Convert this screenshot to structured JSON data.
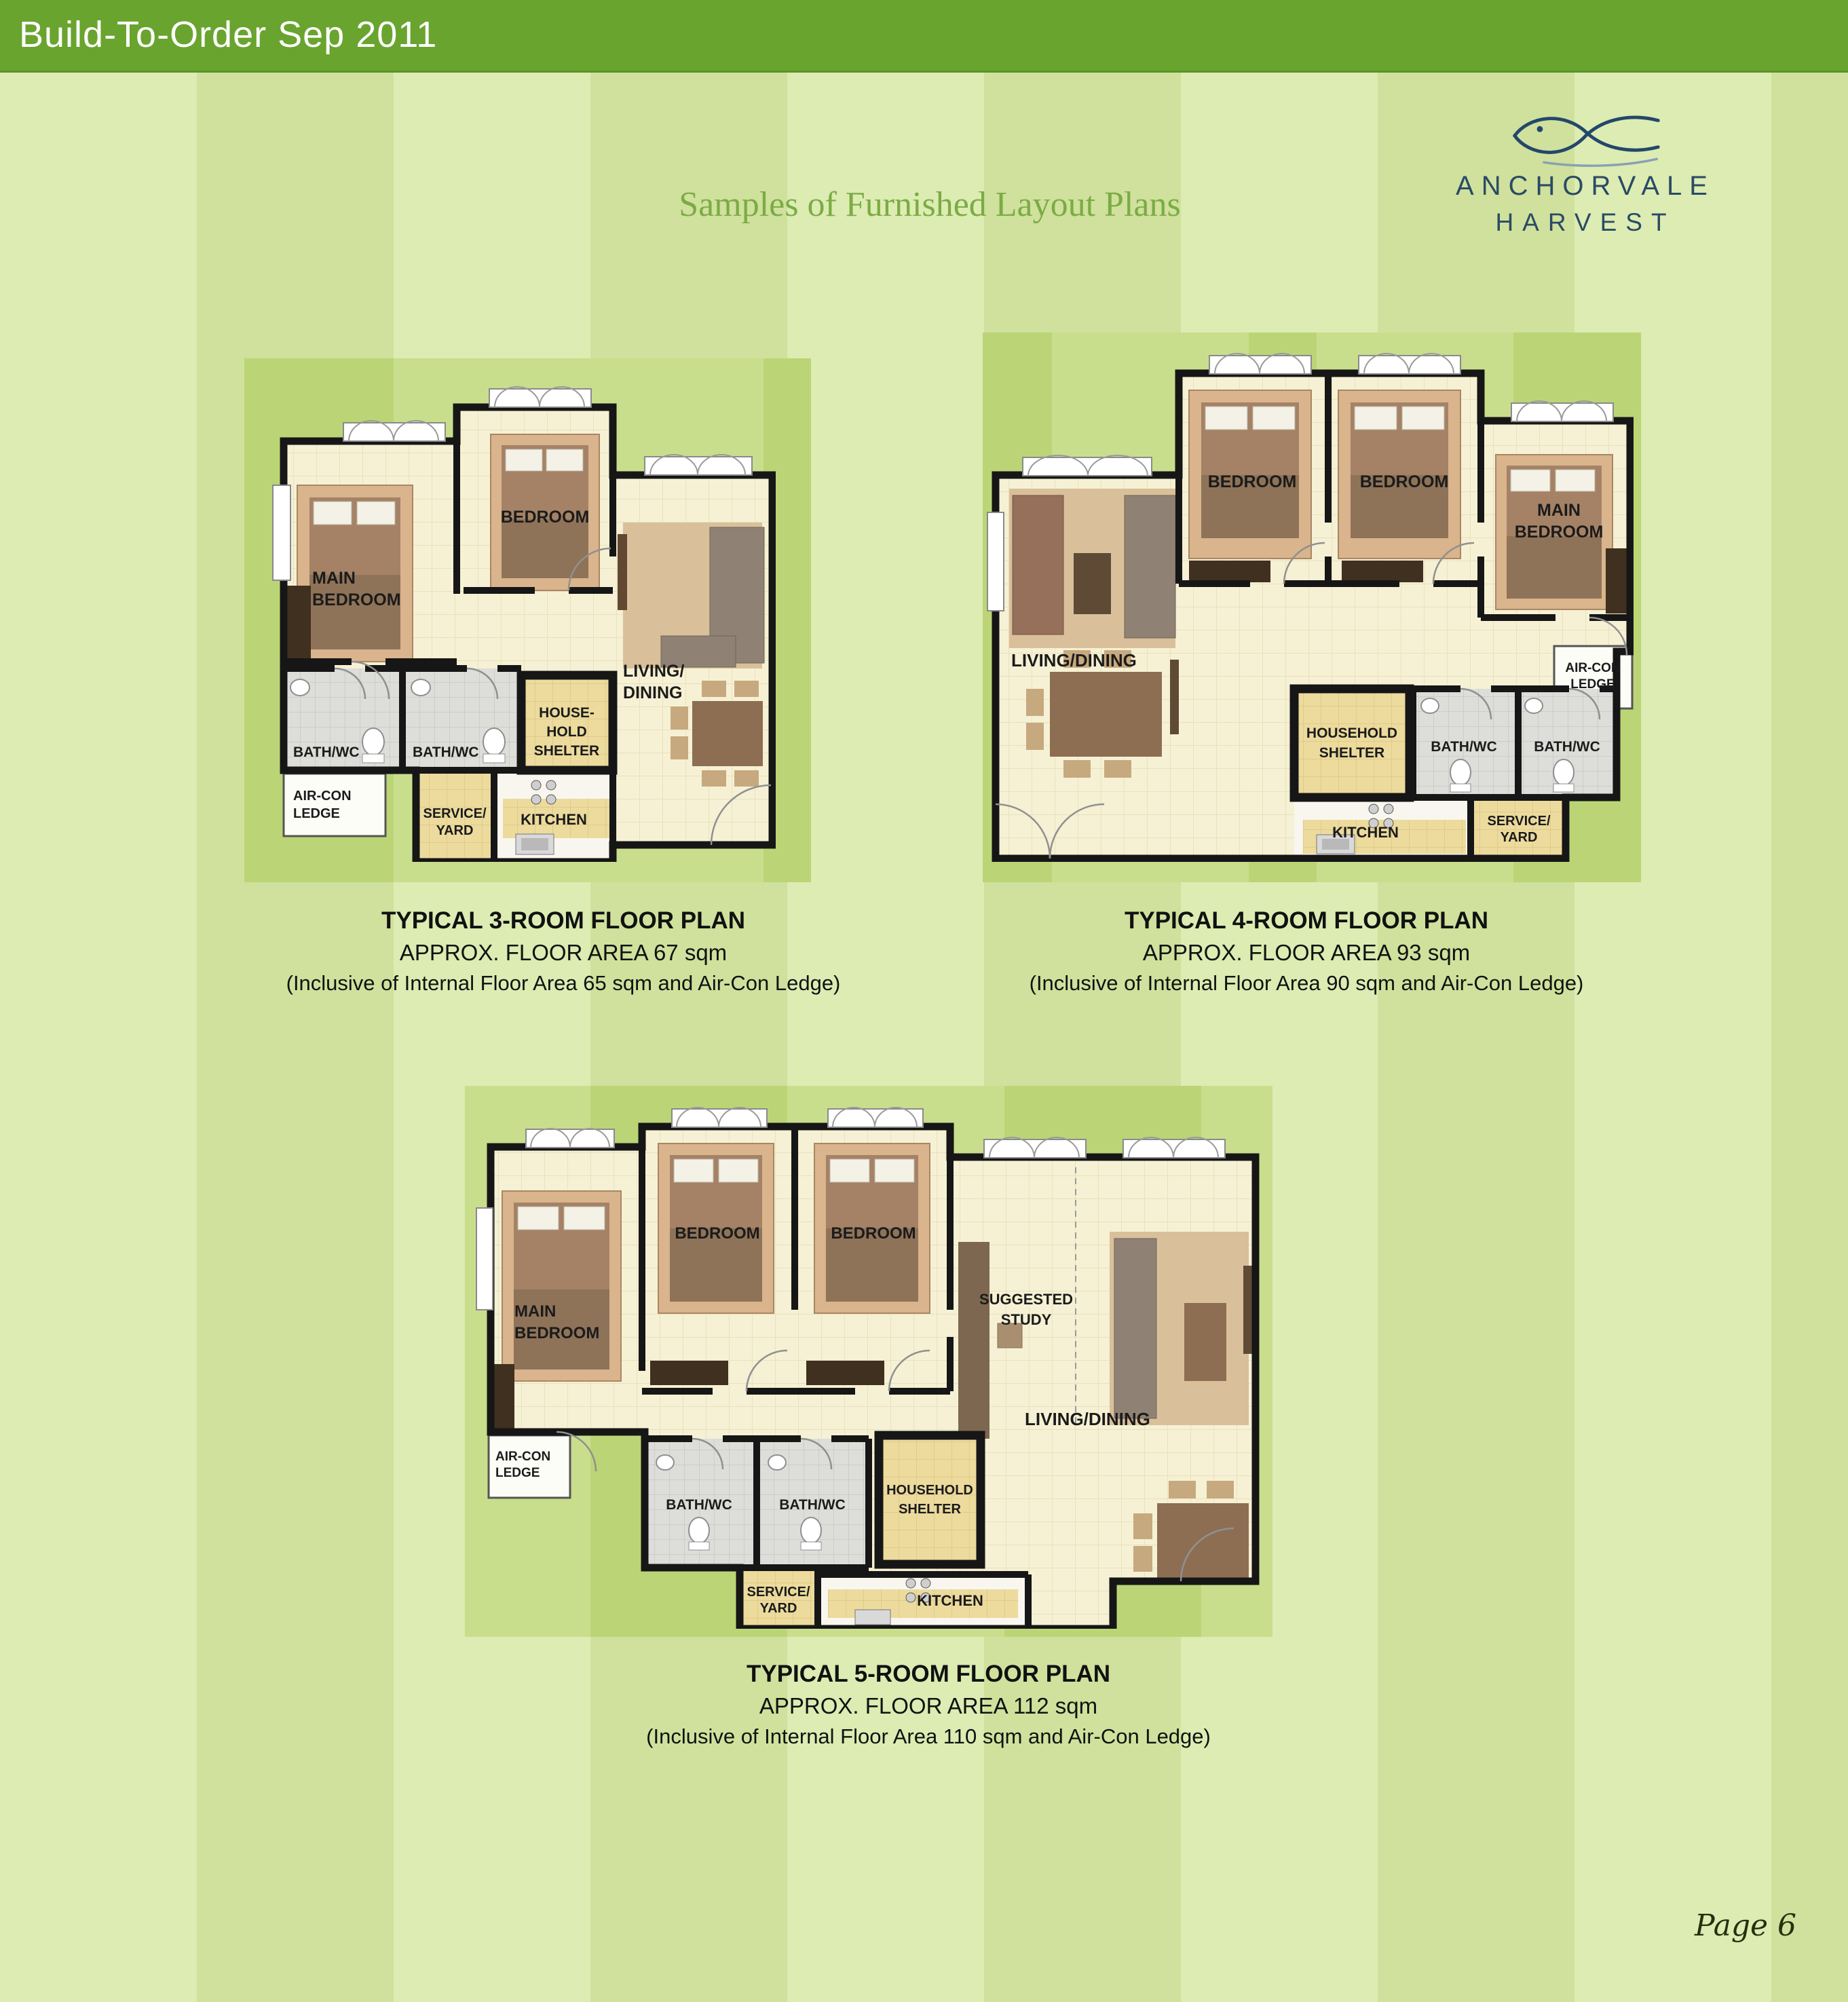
{
  "page": {
    "header": {
      "title": "Build-To-Order Sep 2011",
      "bg_color": "#69a42f",
      "text_color": "#ffffff"
    },
    "title": {
      "text": "Samples of Furnished Layout Plans",
      "color": "#7cab45"
    },
    "logo": {
      "line1": "ANCHORVALE",
      "line2": "HARVEST",
      "icon": "fish-logo-icon",
      "color": "#2b4a66"
    },
    "page_number": "Page 6",
    "background": {
      "stripe_light": "#dcecb2",
      "stripe_dark": "#cfe19c",
      "plan_stripe_light": "#c9de8c",
      "plan_stripe_dark": "#bbd576"
    }
  },
  "plans": [
    {
      "name": "3-room",
      "caption": {
        "line1": "TYPICAL 3-ROOM FLOOR PLAN",
        "line2": "APPROX. FLOOR AREA 67 sqm",
        "line3": "(Inclusive of Internal Floor Area 65 sqm and Air-Con Ledge)"
      },
      "labels": {
        "main_bedroom": [
          "MAIN",
          "BEDROOM"
        ],
        "bedroom": [
          "BEDROOM"
        ],
        "living_dining": [
          "LIVING/",
          "DINING"
        ],
        "bath1": [
          "BATH/WC"
        ],
        "bath2": [
          "BATH/WC"
        ],
        "household_shelter": [
          "HOUSE-",
          "HOLD",
          "SHELTER"
        ],
        "aircon_ledge": [
          "AIR-CON",
          "LEDGE"
        ],
        "service_yard": [
          "SERVICE/",
          "YARD"
        ],
        "kitchen": [
          "KITCHEN"
        ]
      }
    },
    {
      "name": "4-room",
      "caption": {
        "line1": "TYPICAL 4-ROOM FLOOR PLAN",
        "line2": "APPROX. FLOOR AREA 93 sqm",
        "line3": "(Inclusive of Internal Floor Area 90 sqm and Air-Con Ledge)"
      },
      "labels": {
        "bedroom1": [
          "BEDROOM"
        ],
        "bedroom2": [
          "BEDROOM"
        ],
        "main_bedroom": [
          "MAIN",
          "BEDROOM"
        ],
        "living_dining": [
          "LIVING/DINING"
        ],
        "household_shelter": [
          "HOUSEHOLD",
          "SHELTER"
        ],
        "bath1": [
          "BATH/WC"
        ],
        "bath2": [
          "BATH/WC"
        ],
        "aircon_ledge": [
          "AIR-CON",
          "LEDGE"
        ],
        "kitchen": [
          "KITCHEN"
        ],
        "service_yard": [
          "SERVICE/",
          "YARD"
        ]
      }
    },
    {
      "name": "5-room",
      "caption": {
        "line1": "TYPICAL 5-ROOM FLOOR PLAN",
        "line2": "APPROX. FLOOR AREA 112 sqm",
        "line3": "(Inclusive of Internal Floor Area 110 sqm and Air-Con Ledge)"
      },
      "labels": {
        "main_bedroom": [
          "MAIN",
          "BEDROOM"
        ],
        "bedroom1": [
          "BEDROOM"
        ],
        "bedroom2": [
          "BEDROOM"
        ],
        "suggested_study": [
          "SUGGESTED",
          "STUDY"
        ],
        "living_dining": [
          "LIVING/DINING"
        ],
        "aircon_ledge": [
          "AIR-CON",
          "LEDGE"
        ],
        "bath1": [
          "BATH/WC"
        ],
        "bath2": [
          "BATH/WC"
        ],
        "household_shelter": [
          "HOUSEHOLD",
          "SHELTER"
        ],
        "service_yard": [
          "SERVICE/",
          "YARD"
        ],
        "kitchen": [
          "KITCHEN"
        ]
      }
    }
  ]
}
